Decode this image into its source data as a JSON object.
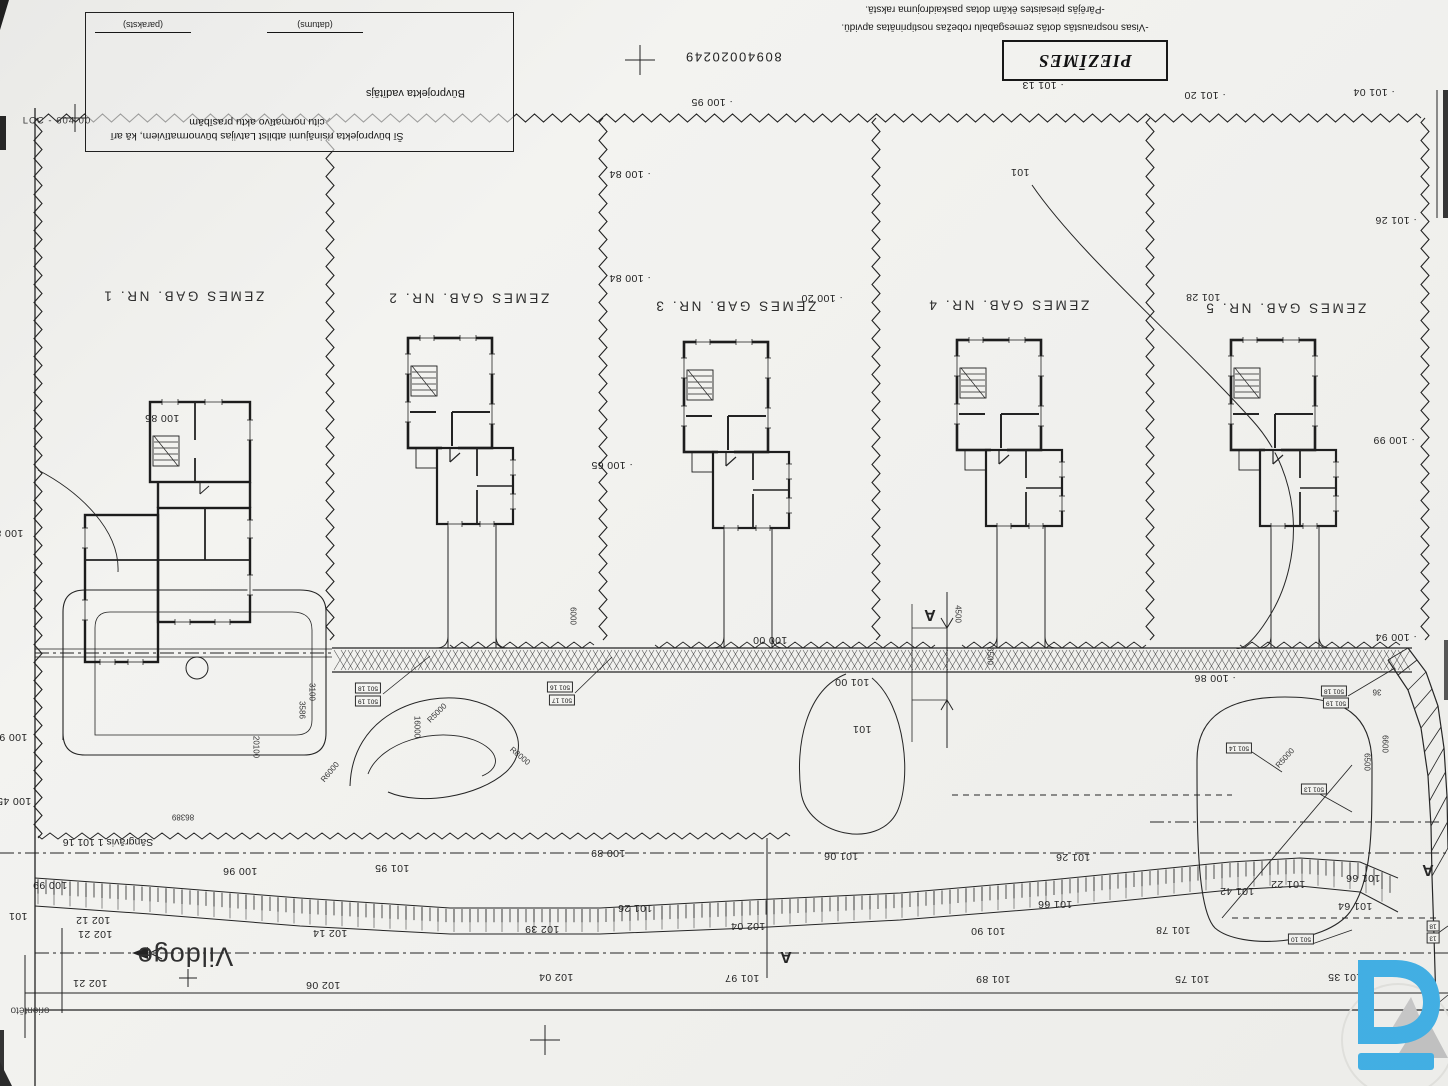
{
  "sheet": {
    "cadastre_number": "80940020249",
    "edge_code": "LCC - 604 00",
    "corner_fragment": "orientēto"
  },
  "title_block": {
    "declaration_line1": "Šī būvprojekta risinājumi atbilst Latvijas būvnormatīviem, kā arī",
    "declaration_line2": "citu normatīvo aktu prasībām",
    "role_label": "Būvprojekta vadītājs",
    "signature_caption": "(paraksts)",
    "date_caption": "(datums)"
  },
  "notes_box": {
    "title": "PIEZĪMES"
  },
  "notes": [
    {
      "x": 995,
      "y": 27,
      "t": "-Visas nospraustās dotās zemesgabalu robežas nostiprinātas apvidū."
    },
    {
      "x": 985,
      "y": 9,
      "t": "-Pārējās piesaistes ēkām dotas paskaidrojuma rakstā."
    }
  ],
  "river": {
    "name": "Vildoge",
    "ditch_label": "Sāngrāvis 1 101 16"
  },
  "plots": [
    {
      "x": 183,
      "y": 296,
      "t": "ZEMES GAB. NR. 1"
    },
    {
      "x": 468,
      "y": 298,
      "t": "ZEMES GAB. NR. 2"
    },
    {
      "x": 735,
      "y": 306,
      "t": "ZEMES GAB. NR. 3"
    },
    {
      "x": 1008,
      "y": 305,
      "t": "ZEMES GAB. NR. 4"
    },
    {
      "x": 1285,
      "y": 308,
      "t": "ZEMES GAB. NR. 5"
    }
  ],
  "section_marks": [
    {
      "x": 930,
      "y": 614,
      "t": "A"
    },
    {
      "x": 786,
      "y": 956,
      "t": "A"
    },
    {
      "x": 1428,
      "y": 869,
      "t": "A"
    }
  ],
  "elevations": [
    {
      "x": 712,
      "y": 102,
      "t": "· 100 95"
    },
    {
      "x": 1043,
      "y": 85,
      "t": "· 101 13"
    },
    {
      "x": 1205,
      "y": 95,
      "t": "· 101 20"
    },
    {
      "x": 1374,
      "y": 92,
      "t": "· 101 04"
    },
    {
      "x": 1396,
      "y": 220,
      "t": "· 101 26"
    },
    {
      "x": 1203,
      "y": 297,
      "t": "101 28"
    },
    {
      "x": 630,
      "y": 174,
      "t": "· 100 84"
    },
    {
      "x": 630,
      "y": 278,
      "t": "· 100 84"
    },
    {
      "x": 822,
      "y": 298,
      "t": "· 100 20"
    },
    {
      "x": 612,
      "y": 465,
      "t": "· 100 65"
    },
    {
      "x": 1394,
      "y": 440,
      "t": "· 100 99"
    },
    {
      "x": 162,
      "y": 418,
      "t": "100 85"
    },
    {
      "x": 1396,
      "y": 637,
      "t": "· 100 94"
    },
    {
      "x": 770,
      "y": 640,
      "t": "100 00"
    },
    {
      "x": 852,
      "y": 682,
      "t": "101 00"
    },
    {
      "x": 1215,
      "y": 678,
      "t": "· 100 86"
    },
    {
      "x": 6,
      "y": 533,
      "t": "100 81"
    },
    {
      "x": 10,
      "y": 737,
      "t": "100 91"
    },
    {
      "x": 14,
      "y": 801,
      "t": "100 45"
    },
    {
      "x": 240,
      "y": 871,
      "t": "100 96"
    },
    {
      "x": 50,
      "y": 885,
      "t": "100 99"
    },
    {
      "x": 18,
      "y": 916,
      "t": "101"
    },
    {
      "x": 93,
      "y": 920,
      "t": "102 12"
    },
    {
      "x": 95,
      "y": 934,
      "t": "102 21"
    },
    {
      "x": 90,
      "y": 983,
      "t": "102 21"
    },
    {
      "x": 330,
      "y": 933,
      "t": "102 14"
    },
    {
      "x": 323,
      "y": 985,
      "t": "102 06"
    },
    {
      "x": 608,
      "y": 853,
      "t": "100 89"
    },
    {
      "x": 841,
      "y": 856,
      "t": "101 06"
    },
    {
      "x": 392,
      "y": 868,
      "t": "101 95"
    },
    {
      "x": 635,
      "y": 908,
      "t": "101 26"
    },
    {
      "x": 542,
      "y": 929,
      "t": "102 39"
    },
    {
      "x": 748,
      "y": 926,
      "t": "102 04"
    },
    {
      "x": 556,
      "y": 977,
      "t": "102 04"
    },
    {
      "x": 742,
      "y": 978,
      "t": "101 97"
    },
    {
      "x": 1073,
      "y": 857,
      "t": "101 26"
    },
    {
      "x": 1055,
      "y": 904,
      "t": "101 66"
    },
    {
      "x": 988,
      "y": 931,
      "t": "101 90"
    },
    {
      "x": 1173,
      "y": 930,
      "t": "101 78"
    },
    {
      "x": 993,
      "y": 979,
      "t": "101 89"
    },
    {
      "x": 1192,
      "y": 979,
      "t": "101 75"
    },
    {
      "x": 1345,
      "y": 977,
      "t": "101 35"
    },
    {
      "x": 1363,
      "y": 878,
      "t": "101 66"
    },
    {
      "x": 1288,
      "y": 884,
      "t": "101 22"
    },
    {
      "x": 1237,
      "y": 891,
      "t": "101 42"
    },
    {
      "x": 1355,
      "y": 906,
      "t": "101 64"
    },
    {
      "x": 1020,
      "y": 172,
      "t": "101"
    },
    {
      "x": 862,
      "y": 729,
      "t": "101"
    }
  ],
  "dimensions": [
    {
      "x": 417,
      "y": 727,
      "t": "16000",
      "r": 90
    },
    {
      "x": 256,
      "y": 747,
      "t": "20100",
      "r": 90
    },
    {
      "x": 183,
      "y": 817,
      "t": "86389",
      "r": 180
    },
    {
      "x": 573,
      "y": 616,
      "t": "6000",
      "r": 90
    },
    {
      "x": 958,
      "y": 614,
      "t": "4500",
      "r": 90
    },
    {
      "x": 990,
      "y": 656,
      "t": "6500",
      "r": 90
    },
    {
      "x": 1385,
      "y": 744,
      "t": "6600",
      "r": 90
    },
    {
      "x": 1367,
      "y": 762,
      "t": "6500",
      "r": 90
    },
    {
      "x": 312,
      "y": 692,
      "t": "3100",
      "r": 90
    },
    {
      "x": 302,
      "y": 710,
      "t": "3586",
      "r": 90
    },
    {
      "x": 437,
      "y": 713,
      "t": "R5000",
      "r": -45
    },
    {
      "x": 330,
      "y": 772,
      "t": "R6000",
      "r": -50
    },
    {
      "x": 520,
      "y": 756,
      "t": "R8000",
      "r": 40
    },
    {
      "x": 1285,
      "y": 758,
      "t": "R5000",
      "r": -48
    },
    {
      "x": 1377,
      "y": 692,
      "t": "36",
      "r": 180
    }
  ],
  "point_tags": [
    {
      "x": 368,
      "y": 688,
      "t": "501 18"
    },
    {
      "x": 368,
      "y": 701,
      "t": "501 19"
    },
    {
      "x": 560,
      "y": 687,
      "t": "501 16"
    },
    {
      "x": 562,
      "y": 700,
      "t": "501 17"
    },
    {
      "x": 1334,
      "y": 691,
      "t": "501 18"
    },
    {
      "x": 1336,
      "y": 703,
      "t": "501 19"
    },
    {
      "x": 1239,
      "y": 748,
      "t": "501 14"
    },
    {
      "x": 1314,
      "y": 789,
      "t": "501 13"
    },
    {
      "x": 1301,
      "y": 939,
      "t": "501 10"
    },
    {
      "x": 1433,
      "y": 926,
      "t": "18"
    },
    {
      "x": 1433,
      "y": 938,
      "t": "13"
    }
  ],
  "logo": {
    "letter": "D",
    "accent_color": "#3fb1e8",
    "mountain_color": "#c9c9c9"
  }
}
